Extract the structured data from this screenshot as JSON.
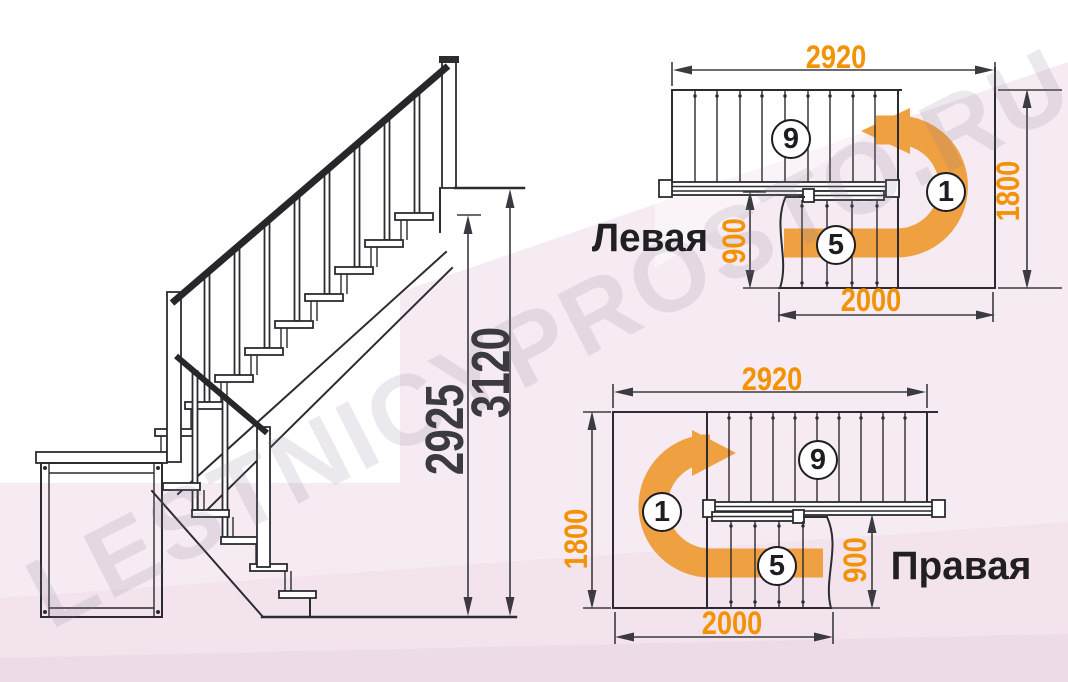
{
  "watermark": {
    "text": "LESTNICYPROSTO.RU"
  },
  "views": {
    "elevation": {
      "dim_height_to_top_step": "2925",
      "dim_total_height": "3120"
    },
    "plan_left": {
      "label": "Левая",
      "dim_width": "2920",
      "dim_depth": "1800",
      "dim_lower_flight_length": "2000",
      "dim_lower_flight_width": "900",
      "badge_upper_flight": "9",
      "badge_landing": "1",
      "badge_lower_flight": "5"
    },
    "plan_right": {
      "label": "Правая",
      "dim_width": "2920",
      "dim_depth": "1800",
      "dim_lower_flight_length": "2000",
      "dim_lower_flight_width": "900",
      "badge_upper_flight": "9",
      "badge_landing": "1",
      "badge_lower_flight": "5"
    }
  },
  "colors": {
    "dimension_orange": "#F29204",
    "arrow_orange": "#EFA041",
    "line_dark": "#2B2B31",
    "dim_dark": "#3A3A40",
    "background_pink": "#F6EBF2"
  }
}
